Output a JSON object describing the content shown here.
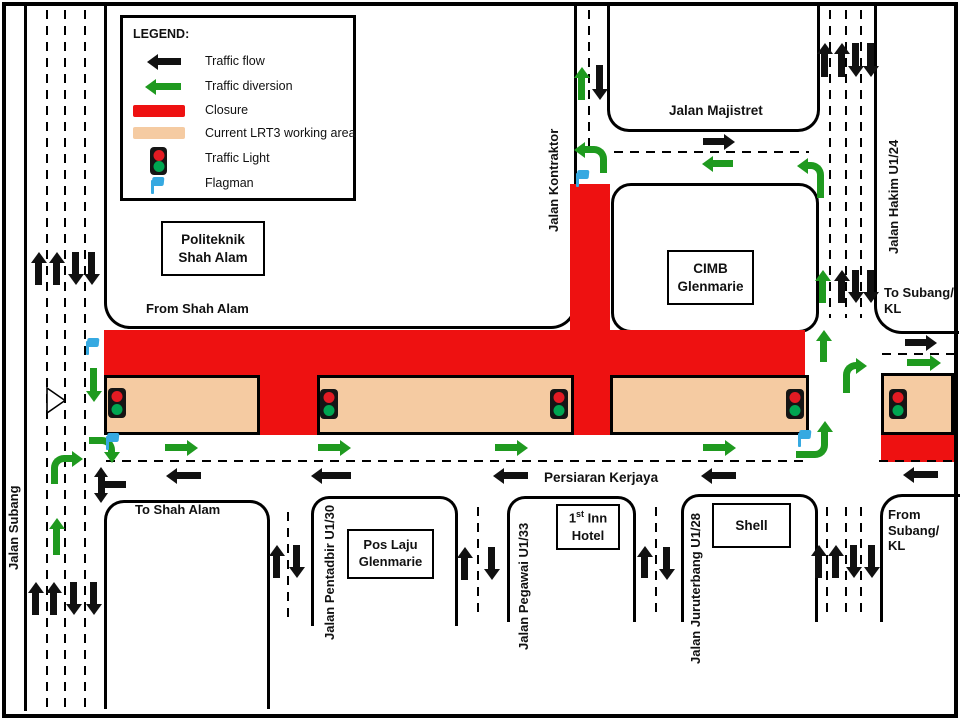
{
  "colors": {
    "closure_red": "#EE1111",
    "working_area_peach": "#F5CBA2",
    "diversion_green": "#1F9A1F",
    "traffic_flow_black": "#111111",
    "flagman_blue": "#36A9E1",
    "signal_red": "#E31B23",
    "signal_green": "#00A651"
  },
  "legend": {
    "title": "LEGEND:",
    "items": {
      "traffic_flow": "Traffic flow",
      "traffic_diversion": "Traffic diversion",
      "closure": "Closure",
      "working_area": "Current LRT3 working area",
      "traffic_light": "Traffic Light",
      "flagman": "Flagman"
    }
  },
  "roads": {
    "jalan_subang": "Jalan Subang",
    "jalan_kontraktor": "Jalan Kontraktor",
    "jalan_majistret": "Jalan Majistret",
    "jalan_hakim": "Jalan Hakim U1/24",
    "persiaran_kerjaya": "Persiaran Kerjaya",
    "jalan_pentadbir": "Jalan Pentadbir U1/30",
    "jalan_pegawai": "Jalan Pegawai U1/33",
    "jalan_juruterbang": "Jalan Juruterbang U1/28"
  },
  "places": {
    "politeknik": {
      "line1": "Politeknik",
      "line2": "Shah Alam"
    },
    "cimb": {
      "line1": "CIMB",
      "line2": "Glenmarie"
    },
    "pos_laju": {
      "line1": "Pos Laju",
      "line2": "Glenmarie"
    },
    "first_inn_hotel": {
      "num": "1",
      "sup": "st",
      "rest": " Inn",
      "line2": "Hotel"
    },
    "shell": {
      "label": "Shell"
    }
  },
  "directions": {
    "from_shah_alam": "From Shah Alam",
    "to_shah_alam": "To Shah Alam",
    "to_subang": {
      "line1": "To Subang/",
      "line2": "KL"
    },
    "from_subang": {
      "line1": "From",
      "line2": "Subang/",
      "line3": "KL"
    }
  }
}
